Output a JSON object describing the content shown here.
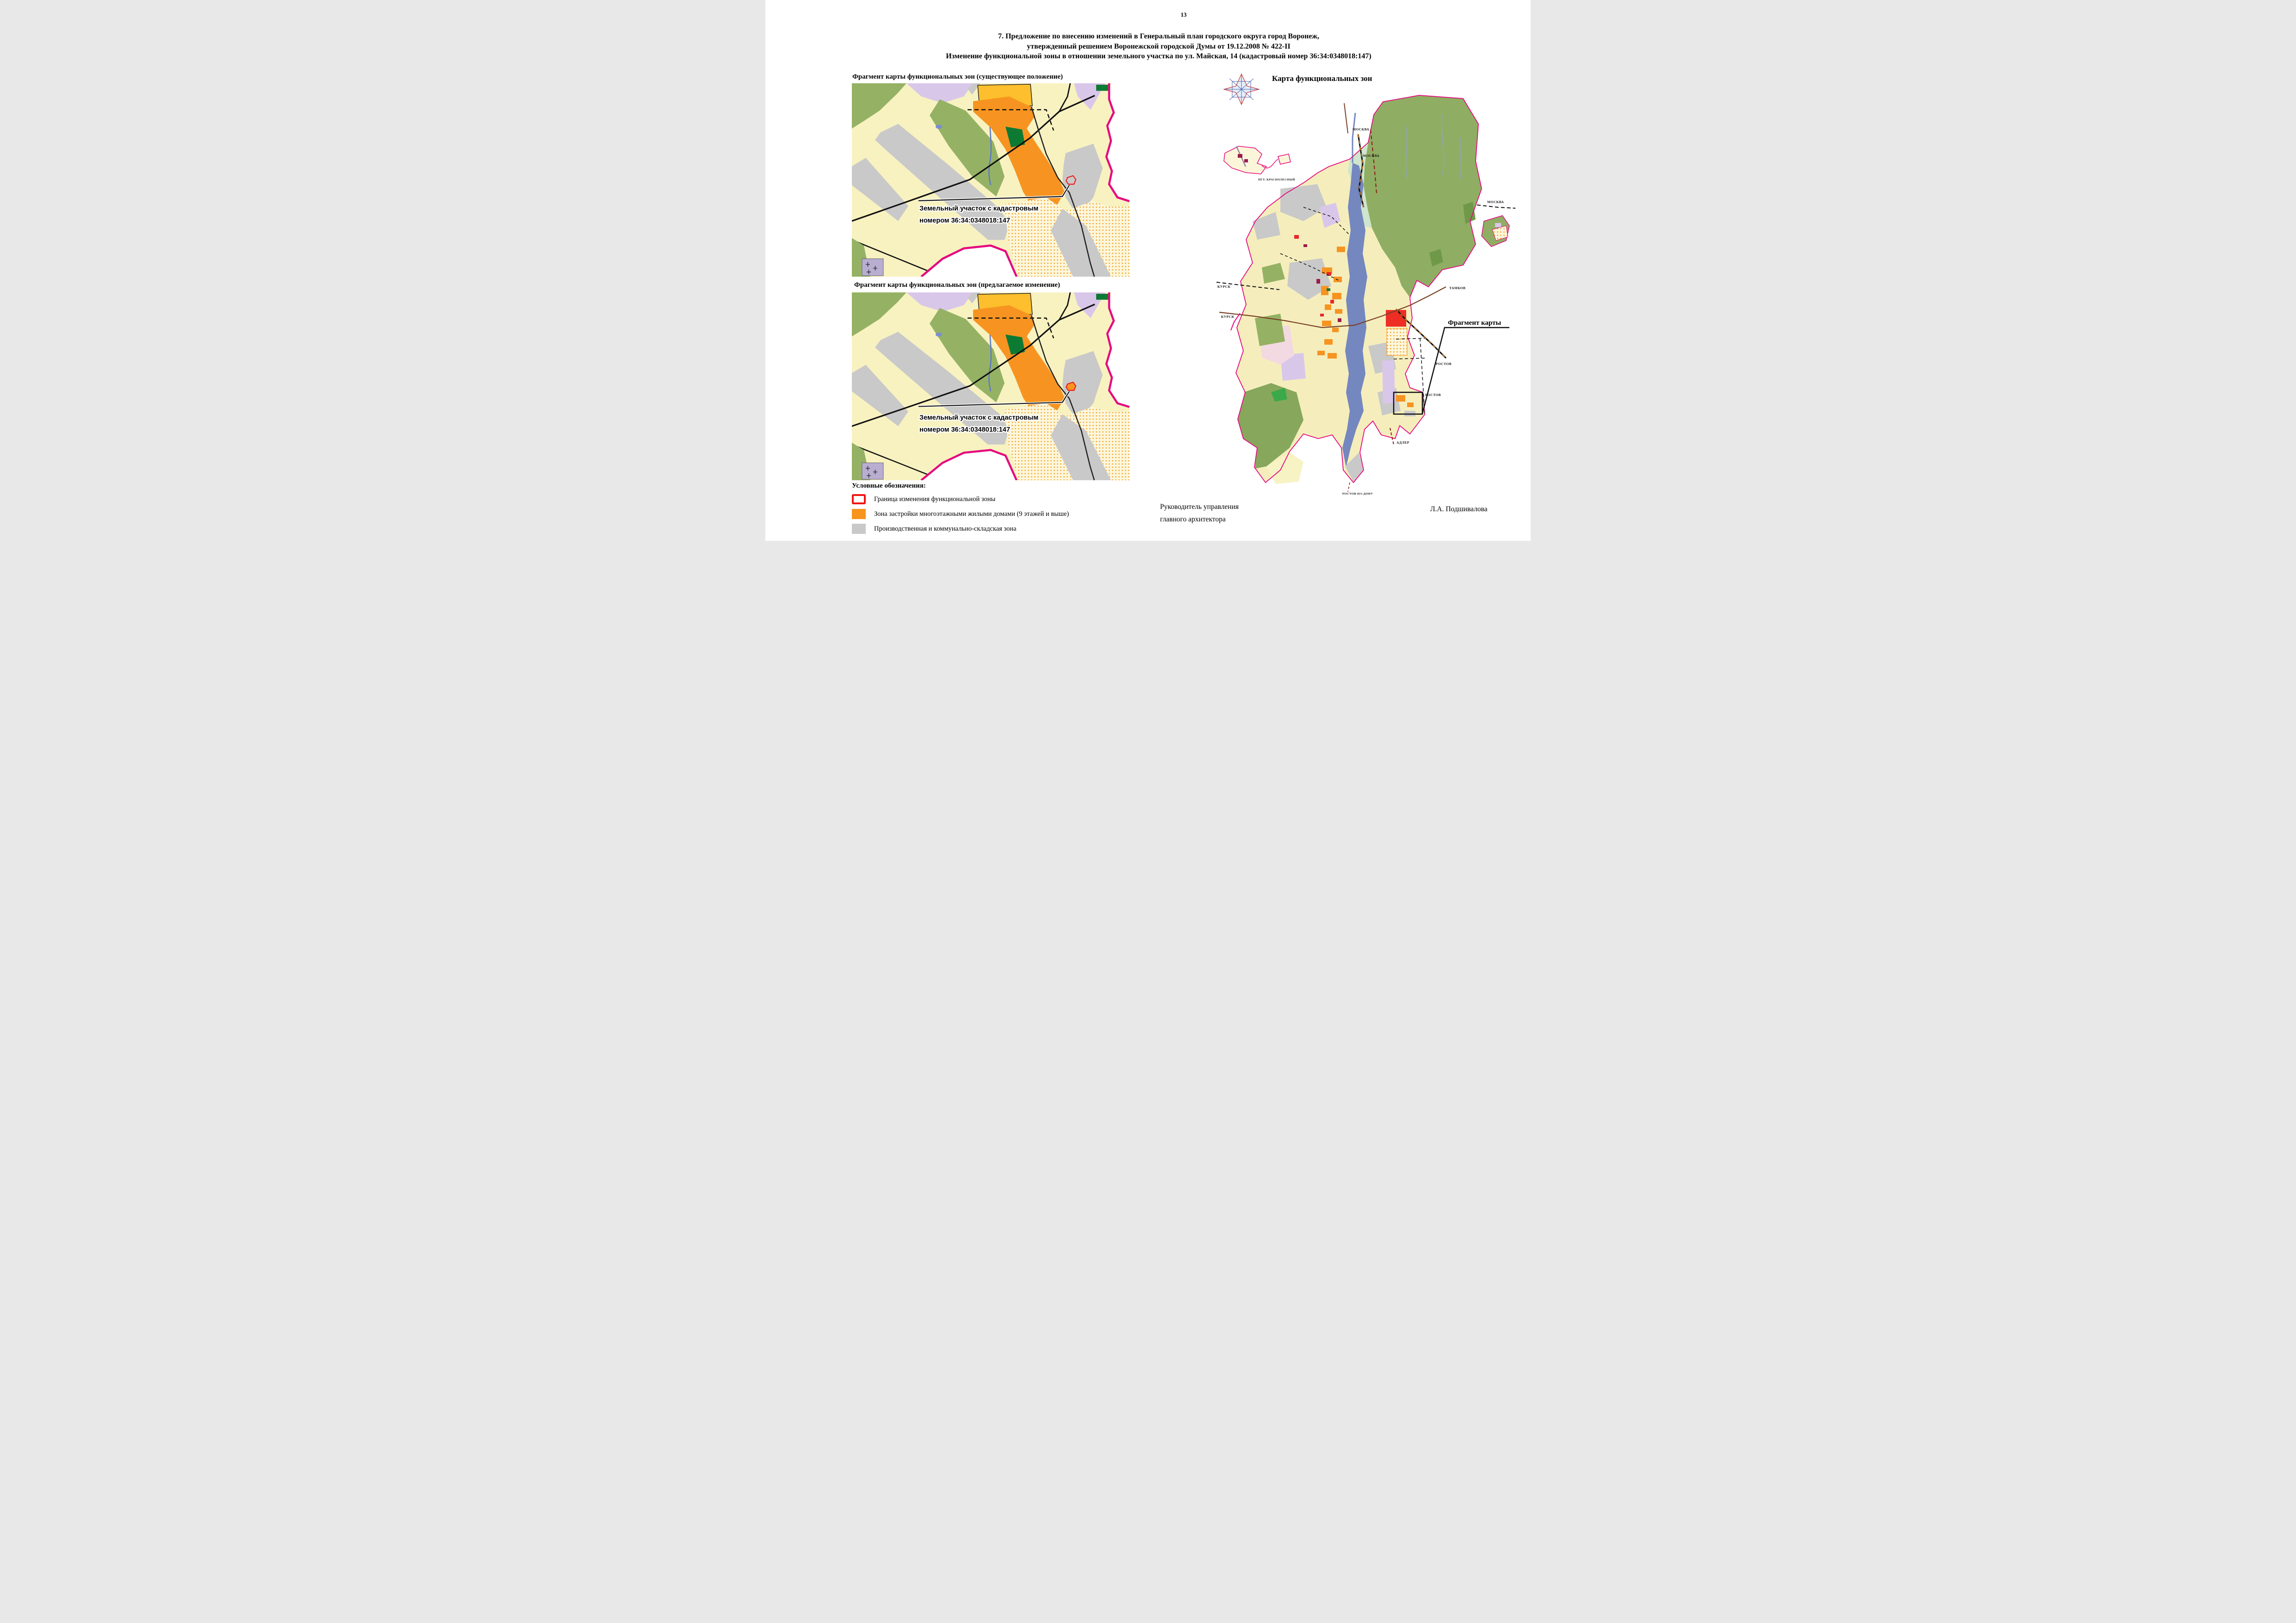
{
  "page": {
    "number": "13"
  },
  "title": {
    "line1": "7. Предложение по внесению изменений в Генеральный план городского округа город Воронеж,",
    "line2": "утвержденный решением Воронежской городской Думы от 19.12.2008 № 422-II",
    "line3": "Изменение функциональной зоны в отношении земельного участка по ул. Майская, 14 (кадастровый номер 36:34:0348018:147)"
  },
  "fragments": {
    "existing_heading": "Фрагмент карты функциональных зон (существующее положение)",
    "proposed_heading": "Фрагмент карты функциональных зон (предлагаемое изменение)",
    "parcel_label": {
      "line1": "Земельный участок с кадастровым",
      "line2": "номером 36:34:0348018:147"
    }
  },
  "legend": {
    "heading": "Условные обозначения:",
    "items": [
      {
        "swatch": "red-outline",
        "label": "Граница изменения функциональной зоны"
      },
      {
        "swatch": "orange",
        "label": "Зона застройки многоэтажными жилыми домами (9 этажей и выше)"
      },
      {
        "swatch": "gray",
        "label": "Производственная и коммунально-складская зона"
      }
    ]
  },
  "overview_map": {
    "title": "Карта функциональных зон",
    "fragment_callout": "Фрагмент карты",
    "labels": {
      "moscow1": "МОСКВА",
      "moscow2": "МОСКВА",
      "moscow3": "МОСКВА",
      "kursk1": "КУРСК",
      "kursk2": "КУРСК",
      "tambov": "ТАМБОВ",
      "rostov1": "РОСТОВ",
      "rostov2": "РОСТОВ",
      "adler": "АДЛЕР",
      "rostov_na_donu": "РОСТОВ-НА-ДОНУ",
      "krasnolesny": "ПГТ. КРАСНОЛЕСНЫЙ"
    }
  },
  "signature": {
    "role_line1": "Руководитель управления",
    "role_line2": "главного архитектора",
    "name": "Л.А. Подшивалова"
  },
  "colors": {
    "boundary_pink": "#E5097F",
    "zone_orange": "#F7941D",
    "zone_amber": "#FDBF2D",
    "zone_gray": "#C9C9C9",
    "zone_pale_yellow": "#F8F2C0",
    "zone_green": "#95B264",
    "zone_dark_green": "#0D7A34",
    "zone_lavender": "#D9C7EA",
    "water_blue": "#7487BF",
    "parcel_border_red": "#F01414"
  }
}
